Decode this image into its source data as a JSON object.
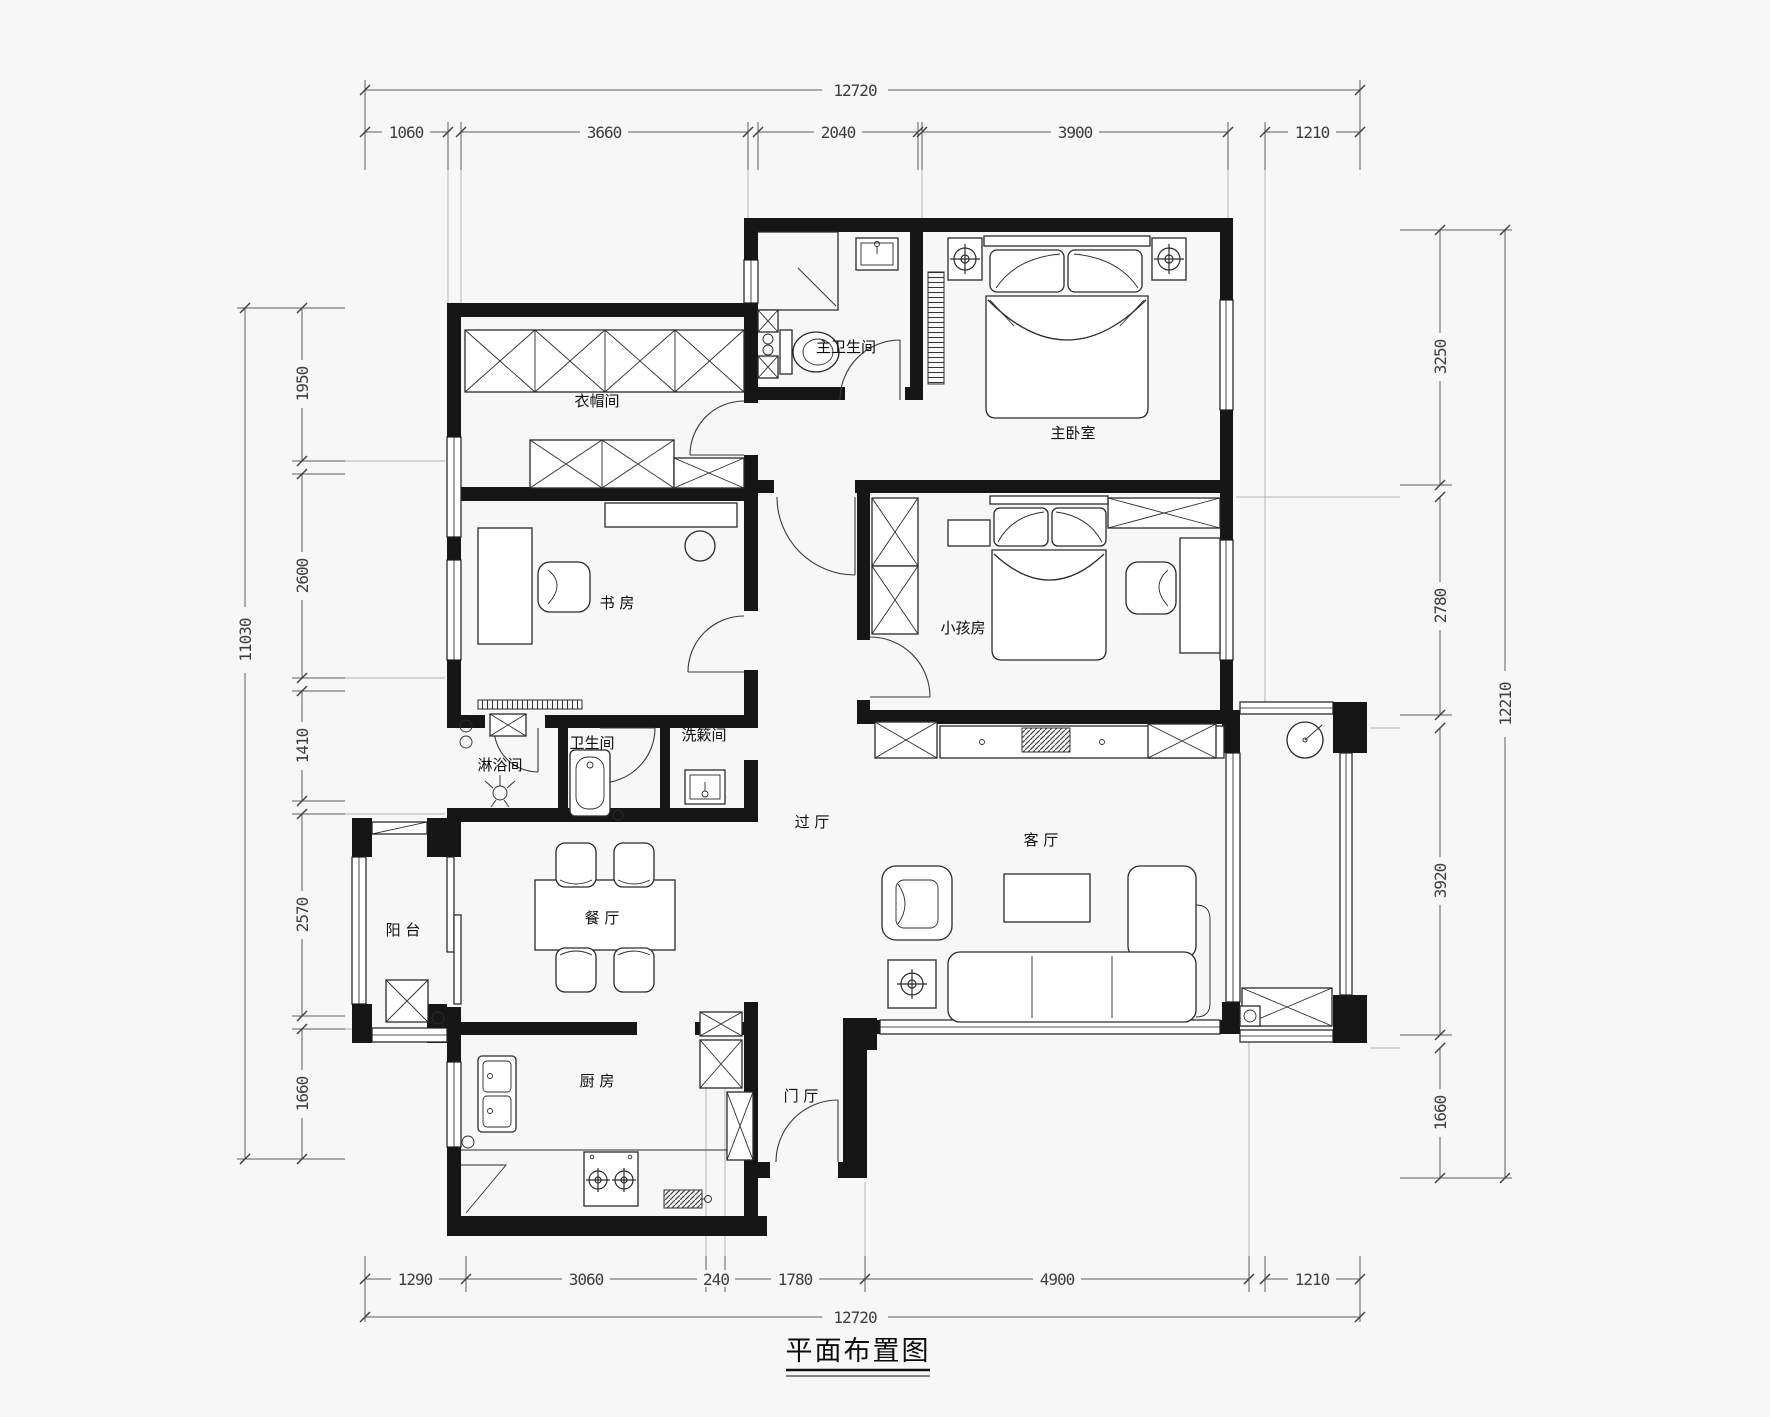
{
  "title": "平面布置图",
  "rooms": {
    "master_bathroom": "主卫生间",
    "master_bedroom": "主卧室",
    "cloakroom": "衣帽间",
    "study": "书 房",
    "kids_room": "小孩房",
    "shower_room": "淋浴间",
    "bathroom": "卫生间",
    "washroom": "洗簌间",
    "hallway": "过 厅",
    "living_room": "客 厅",
    "balcony": "阳 台",
    "dining_room": "餐 厅",
    "kitchen": "厨 房",
    "entrance": "门 厅"
  },
  "dimensions": {
    "top": {
      "total": "12720",
      "segments": [
        "1060",
        "3660",
        "2040",
        "3900",
        "1210"
      ]
    },
    "bottom": {
      "total": "12720",
      "segments": [
        "1290",
        "3060",
        "240",
        "1780",
        "4900",
        "1210"
      ]
    },
    "left": {
      "total": "11030",
      "segments": [
        "1950",
        "2600",
        "1410",
        "2570",
        "1660"
      ]
    },
    "right": {
      "total": "12210",
      "segments": [
        "3250",
        "2780",
        "3920",
        "1660"
      ]
    }
  },
  "colors": {
    "wall": "#161616",
    "line": "#2b2b2b",
    "dimension_line": "#5e5e5e",
    "dimension_text": "#3d3d3d",
    "background": "#f7f7f7"
  }
}
